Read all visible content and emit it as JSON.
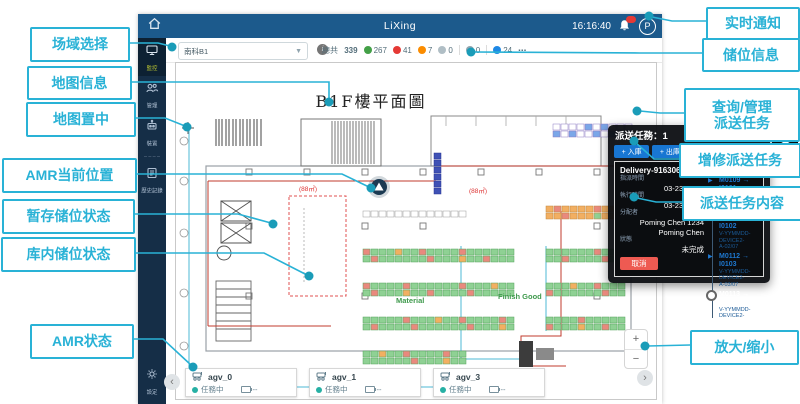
{
  "callouts": {
    "left": [
      {
        "label": "场域选择"
      },
      {
        "label": "地图信息"
      },
      {
        "label": "地图置中"
      },
      {
        "label": "AMR当前位置"
      },
      {
        "label": "暂存储位状态"
      },
      {
        "label": "库内储位状态"
      },
      {
        "label": "AMR状态"
      }
    ],
    "right": [
      {
        "label": "实时通知"
      },
      {
        "label": "储位信息"
      },
      {
        "label": "查询/管理",
        "label2": "派送任务"
      },
      {
        "label": "增修派送任务"
      },
      {
        "label": "派送任务内容"
      },
      {
        "label": "放大/缩小"
      }
    ]
  },
  "app": {
    "topbar": {
      "title": "LiXing",
      "time": "16:16:40",
      "avatar": "P"
    },
    "sidebar": {
      "items": [
        {
          "label": "監控"
        },
        {
          "label": "管理"
        },
        {
          "label": "裝置"
        },
        {
          "label": "歷史記錄"
        }
      ],
      "settings_label": "設定"
    },
    "toolbar": {
      "site_select": "南科B1",
      "stats": {
        "total_label": "總共",
        "total": "339",
        "items": [
          {
            "value": "267",
            "color": "#43a047"
          },
          {
            "value": "41",
            "color": "#e53935"
          },
          {
            "value": "7",
            "color": "#fb8c00"
          },
          {
            "value": "0",
            "color": "#b0bec5"
          },
          {
            "value": "0",
            "color": "#90a4ae"
          },
          {
            "value": "24",
            "color": "#1e88e5"
          }
        ],
        "more": "⋯"
      }
    },
    "map": {
      "title": "B1F樓平面圖",
      "labels": {
        "material": "Material",
        "finish_good": "Finish Good",
        "area1": "(88㎡)",
        "area2": "(88㎡)"
      }
    },
    "task_panel": {
      "title": "派送任務：1",
      "close": "✕",
      "buttons": [
        {
          "label": "+ 入庫"
        },
        {
          "label": "+ 出庫"
        },
        {
          "label": "+ 整理"
        },
        {
          "label": "+ 快速"
        }
      ],
      "card": {
        "id": "Delivery-91630689",
        "progress": "0 / 7",
        "rows": [
          {
            "label": "指派時間",
            "value": "03-23 16:16"
          },
          {
            "label": "執行時間",
            "value": "03-23 16:16"
          },
          {
            "label": "分配者",
            "value": "Poming Chen 1234",
            "value2": "Poming Chen"
          },
          {
            "label": "狀態",
            "value": "未完成"
          }
        ],
        "cancel": "取消",
        "timeline": [
          {
            "text": "M0109 → I0101",
            "sub1": "V-YYMMDD-DEVICE2-",
            "sub2": "A-01/07"
          },
          {
            "text": "M0111 → I0102",
            "sub1": "V-YYMMDD-DEVICE2-",
            "sub2": "A-02/07"
          },
          {
            "text": "M0112 → I0103",
            "sub1": "V-YYMMDD-DEVICE2-",
            "sub2": "A-03/07"
          },
          {
            "text": "M0113 → I0104",
            "sub1": "V-YYMMDD-DEVICE2-"
          }
        ]
      }
    },
    "agv_bar": [
      {
        "name": "agv_0",
        "status": "任務中",
        "battery": "--"
      },
      {
        "name": "agv_1",
        "status": "任務中",
        "battery": "--"
      },
      {
        "name": "agv_3",
        "status": "任務中",
        "battery": "--"
      }
    ],
    "controls": {
      "zoom_in": "+",
      "zoom_out": "−",
      "prev": "‹",
      "next": "›"
    }
  },
  "colors": {
    "topbar": "#1c5a8c",
    "sidebar": "#152e47",
    "callout_accent": "#29b2d6",
    "connector_dot": "#1a9cb8",
    "panel_button_blue": "#1876d2",
    "cancel_red": "#ee5a52",
    "timeline_blue": "#1e78d0",
    "agv_status_teal": "#26b0a4"
  }
}
